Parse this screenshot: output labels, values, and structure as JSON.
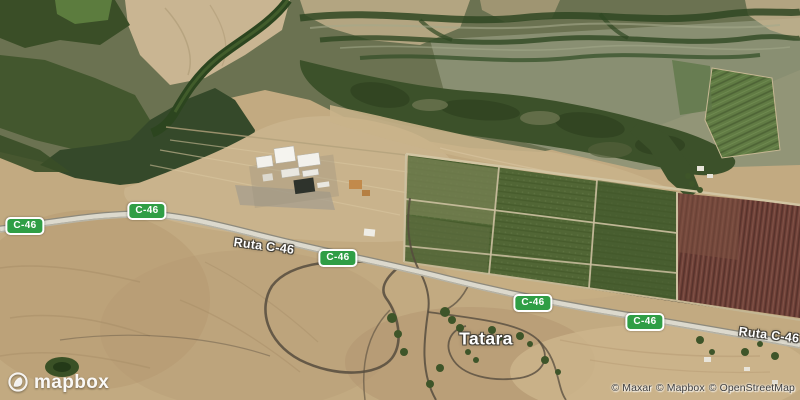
{
  "map": {
    "labels": {
      "place": "Tatara",
      "road_name": "Ruta C-46",
      "route_shield": "C-46"
    },
    "colors": {
      "shield_background": "#2f9e45",
      "shield_border": "#ffffff",
      "road_fill": "#dcd9cd",
      "desert_tan": "#c2aa81",
      "vegetation_dark": "#3a4e27",
      "field_green": "#516635",
      "field_red": "#714239"
    }
  },
  "branding": {
    "logo_text": "mapbox"
  },
  "attribution": {
    "items": [
      "© Maxar",
      "© Mapbox",
      "© OpenStreetMap"
    ]
  }
}
